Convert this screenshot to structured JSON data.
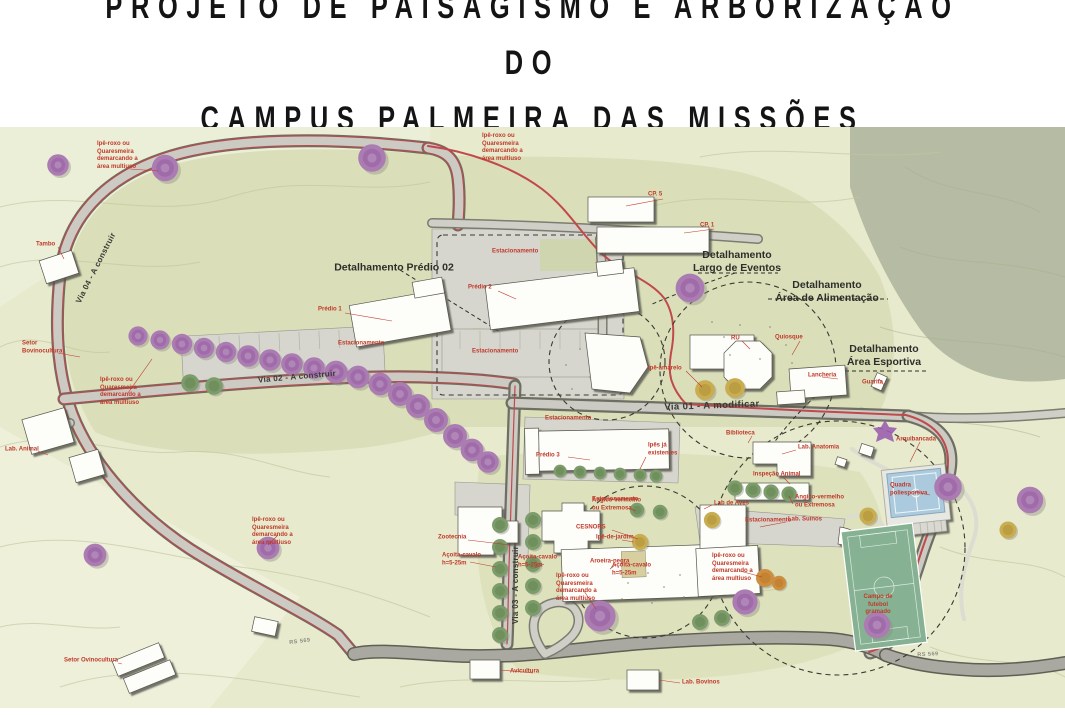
{
  "title": {
    "text": "PROJETO DE PAISAGISMO E ARBORIZAÇÃO DO\nCAMPUS PALMEIRA DAS MISSÕES"
  },
  "map": {
    "colors": {
      "accent_red": "#c0392b",
      "road_red": "#c1494b",
      "map_base": "#e7eacd",
      "map_inner": "#dadfb9",
      "top_right_patch": "#b6bca3",
      "tree_purple": "#aa7cb2",
      "tree_green": "#7d9c6b",
      "court_blue": "#abcadd",
      "field_green": "#86b293"
    },
    "labels": [
      {
        "t": "Detalhamento Prédio 02",
        "x": 394,
        "y": 268,
        "c": "cap",
        "a": "c"
      },
      {
        "t": "Detalhamento\nLargo de Eventos",
        "x": 737,
        "y": 262,
        "c": "cap",
        "a": "c"
      },
      {
        "t": "Detalhamento\nÁrea de Alimentação",
        "x": 827,
        "y": 292,
        "c": "cap",
        "a": "c"
      },
      {
        "t": "Detalhamento\nÁrea Esportiva",
        "x": 884,
        "y": 356,
        "c": "cap",
        "a": "c"
      },
      {
        "t": "Via 01 - A modificar",
        "x": 712,
        "y": 406,
        "c": "road",
        "a": "c",
        "r": -2
      },
      {
        "t": "Via 02 - A construir",
        "x": 297,
        "y": 377,
        "c": "road-sm",
        "a": "c",
        "r": -5
      },
      {
        "t": "Via 03 - A construir",
        "x": 516,
        "y": 585,
        "c": "road-sm",
        "a": "c",
        "r": -90
      },
      {
        "t": "Via 04 - A construir",
        "x": 96,
        "y": 268,
        "c": "road-sm",
        "a": "c",
        "r": -63
      },
      {
        "t": "RS 569",
        "x": 300,
        "y": 642,
        "c": "gray",
        "a": "c",
        "r": -7
      },
      {
        "t": "RS 569",
        "x": 928,
        "y": 655,
        "c": "gray",
        "a": "c",
        "r": -3
      },
      {
        "t": "Ipê-roxo ou\nQuaresmeira\ndemarcando a\nárea multiuso",
        "x": 97,
        "y": 156,
        "c": "red"
      },
      {
        "t": "Ipê-roxo ou\nQuaresmeira\ndemarcando a\nárea multiuso",
        "x": 482,
        "y": 148,
        "c": "red"
      },
      {
        "t": "Ipê-roxo ou\nQuaresmeira\ndemarcando a\nárea multiuso",
        "x": 100,
        "y": 392,
        "c": "red"
      },
      {
        "t": "Ipê-roxo ou\nQuaresmeira\ndemarcando a\nárea multiuso",
        "x": 252,
        "y": 532,
        "c": "red"
      },
      {
        "t": "Ipê-roxo ou\nQuaresmeira\ndemarcando a\nárea multiuso",
        "x": 556,
        "y": 588,
        "c": "red"
      },
      {
        "t": "Ipê-roxo ou\nQuaresmeira\ndemarcando a\nárea multiuso",
        "x": 712,
        "y": 568,
        "c": "red"
      },
      {
        "t": "Tambo",
        "x": 36,
        "y": 245,
        "c": "red"
      },
      {
        "t": "Setor\nBovinocultura",
        "x": 22,
        "y": 348,
        "c": "red"
      },
      {
        "t": "Lab. Animal",
        "x": 5,
        "y": 450,
        "c": "red"
      },
      {
        "t": "Setor Ovinocultura",
        "x": 64,
        "y": 661,
        "c": "red"
      },
      {
        "t": "Prédio 1",
        "x": 318,
        "y": 310,
        "c": "red"
      },
      {
        "t": "Prédio 2",
        "x": 468,
        "y": 288,
        "c": "red"
      },
      {
        "t": "Estacionamento",
        "x": 338,
        "y": 344,
        "c": "red"
      },
      {
        "t": "Estacionamento",
        "x": 472,
        "y": 352,
        "c": "red"
      },
      {
        "t": "Estacionamento",
        "x": 492,
        "y": 252,
        "c": "red"
      },
      {
        "t": "Estacionamento",
        "x": 545,
        "y": 419,
        "c": "red"
      },
      {
        "t": "Estacionamento",
        "x": 592,
        "y": 500,
        "c": "red"
      },
      {
        "t": "Estacionamento",
        "x": 745,
        "y": 521,
        "c": "red"
      },
      {
        "t": "CP. 5",
        "x": 648,
        "y": 195,
        "c": "red"
      },
      {
        "t": "CP. 1",
        "x": 700,
        "y": 226,
        "c": "red"
      },
      {
        "t": "RU",
        "x": 731,
        "y": 339,
        "c": "red"
      },
      {
        "t": "Quiosque",
        "x": 775,
        "y": 338,
        "c": "red"
      },
      {
        "t": "Lancheria",
        "x": 808,
        "y": 376,
        "c": "red"
      },
      {
        "t": "Guarita",
        "x": 862,
        "y": 383,
        "c": "red"
      },
      {
        "t": "Ipê-amarelo",
        "x": 648,
        "y": 369,
        "c": "red"
      },
      {
        "t": "Prédio 3",
        "x": 536,
        "y": 456,
        "c": "red"
      },
      {
        "t": "Ipês já\nexistentes",
        "x": 648,
        "y": 450,
        "c": "red"
      },
      {
        "t": "Zootecnia",
        "x": 438,
        "y": 538,
        "c": "red"
      },
      {
        "t": "CESNORS",
        "x": 576,
        "y": 528,
        "c": "red"
      },
      {
        "t": "Angico-vermelho\nou Extremosa",
        "x": 592,
        "y": 505,
        "c": "red"
      },
      {
        "t": "Ipê-de-jardim",
        "x": 596,
        "y": 538,
        "c": "red"
      },
      {
        "t": "Aroeira-negra",
        "x": 590,
        "y": 562,
        "c": "red"
      },
      {
        "t": "Açoita-cavalo\nh=5-25m",
        "x": 442,
        "y": 560,
        "c": "red"
      },
      {
        "t": "Açoita-cavalo\nh=5-25m",
        "x": 518,
        "y": 562,
        "c": "red"
      },
      {
        "t": "Açoita-cavalo\nh=5-25m",
        "x": 612,
        "y": 570,
        "c": "red"
      },
      {
        "t": "Biblioteca",
        "x": 726,
        "y": 434,
        "c": "red"
      },
      {
        "t": "Lab. Anatomia",
        "x": 798,
        "y": 448,
        "c": "red"
      },
      {
        "t": "Inspeção Animal",
        "x": 753,
        "y": 475,
        "c": "red"
      },
      {
        "t": "Lab de Aves",
        "x": 714,
        "y": 504,
        "c": "red"
      },
      {
        "t": "Angico-vermelho\nou Extremosa",
        "x": 795,
        "y": 502,
        "c": "red"
      },
      {
        "t": "Lab. Suínos",
        "x": 788,
        "y": 520,
        "c": "red"
      },
      {
        "t": "Arquibancada",
        "x": 896,
        "y": 440,
        "c": "red"
      },
      {
        "t": "Quadra\npoliesportiva",
        "x": 890,
        "y": 490,
        "c": "red"
      },
      {
        "t": "Campo de\nfutebol\ngramado",
        "x": 878,
        "y": 605,
        "c": "red",
        "a": "c"
      },
      {
        "t": "Avicultura",
        "x": 510,
        "y": 672,
        "c": "red"
      },
      {
        "t": "Lab. Bovinos",
        "x": 682,
        "y": 683,
        "c": "red"
      }
    ]
  }
}
